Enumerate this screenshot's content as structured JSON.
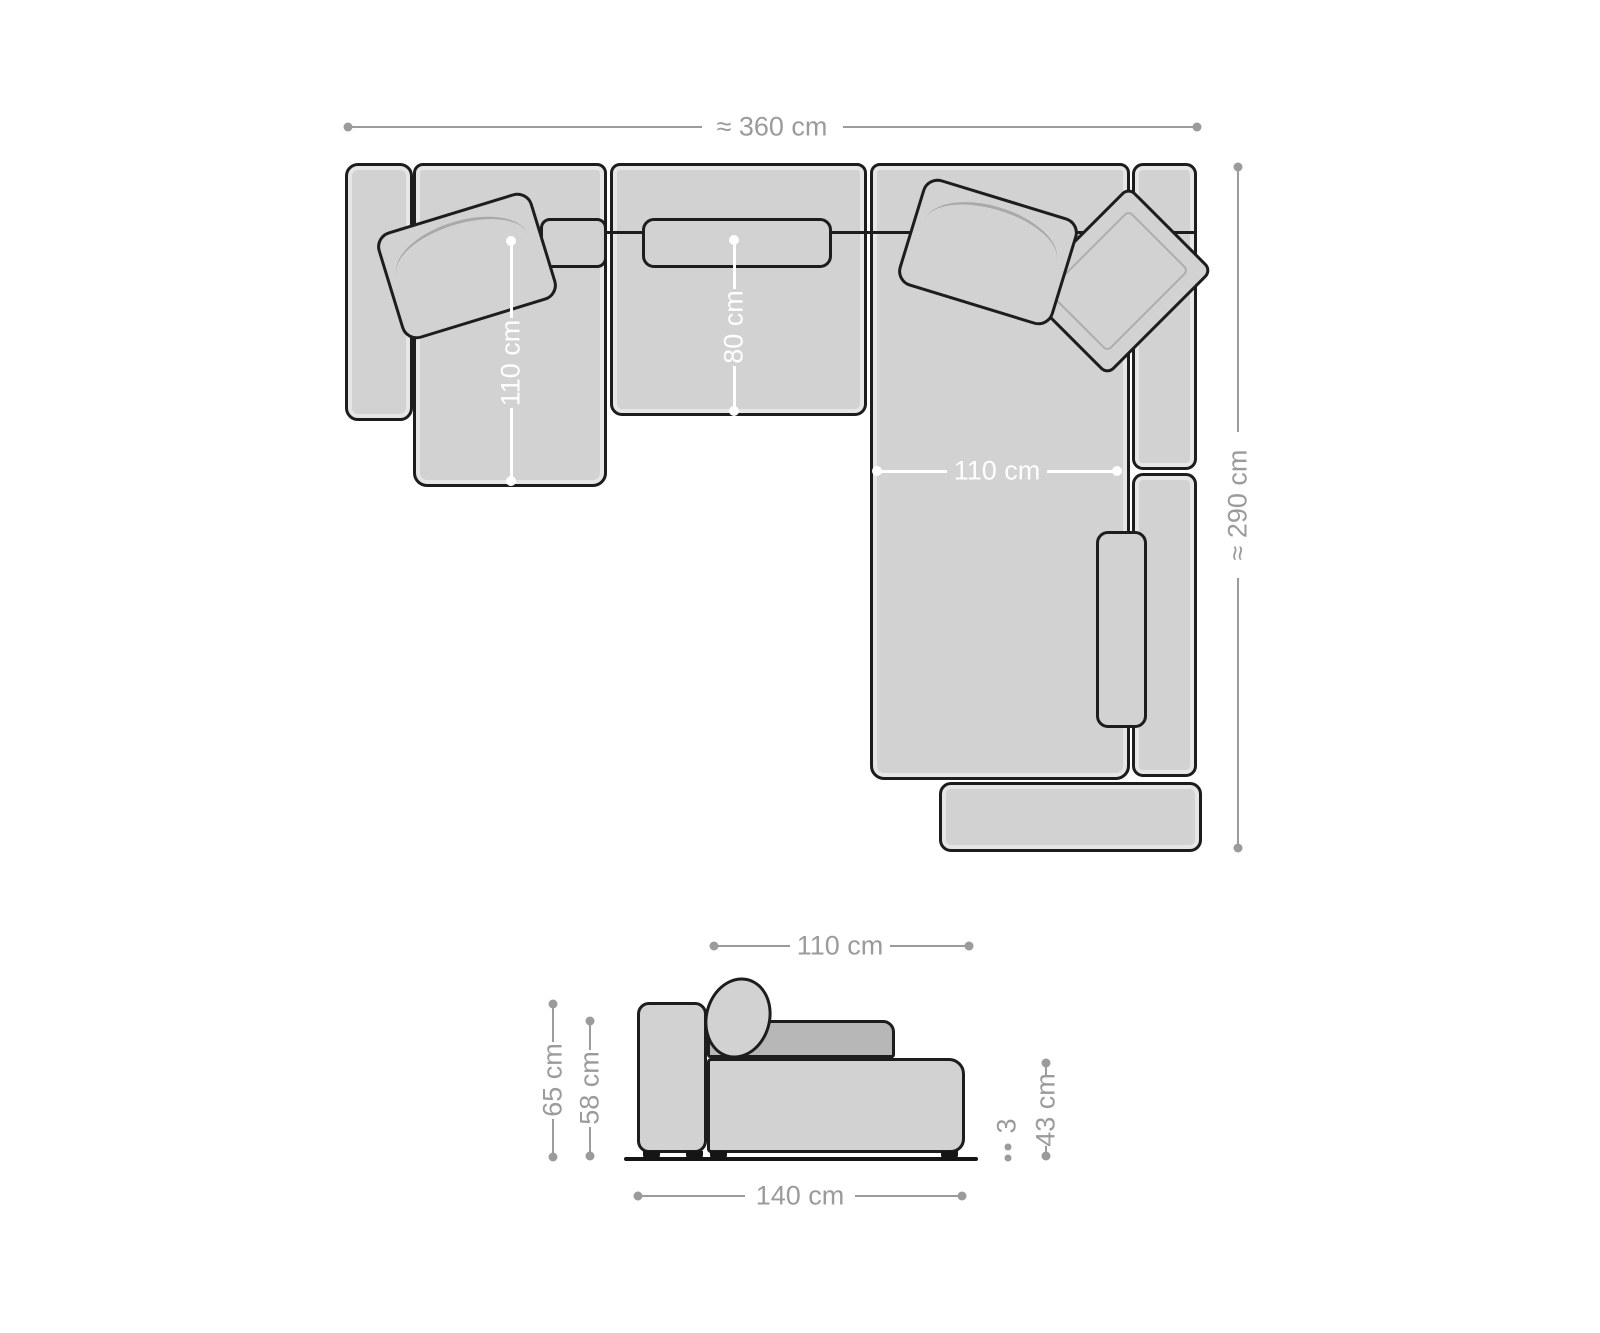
{
  "colors": {
    "sofa_fill": "#d2d2d2",
    "outline": "#1d1d1d",
    "cushion_dark": "#b7b7b7",
    "dimension_gray": "#9b9b9b",
    "dimension_white": "#ffffff",
    "background": "#ffffff"
  },
  "top_view": {
    "total_width_label": "≈ 360 cm",
    "total_depth_label": "≈ 290 cm",
    "left_chaise_depth_label": "110 cm",
    "middle_seat_depth_label": "80 cm",
    "right_chaise_width_label": "110 cm"
  },
  "side_view": {
    "seat_depth_label": "110 cm",
    "total_height_label": "65 cm",
    "back_height_label": "58 cm",
    "feet_height_label": "3",
    "seat_height_label": "43 cm",
    "module_width_label": "140 cm"
  }
}
